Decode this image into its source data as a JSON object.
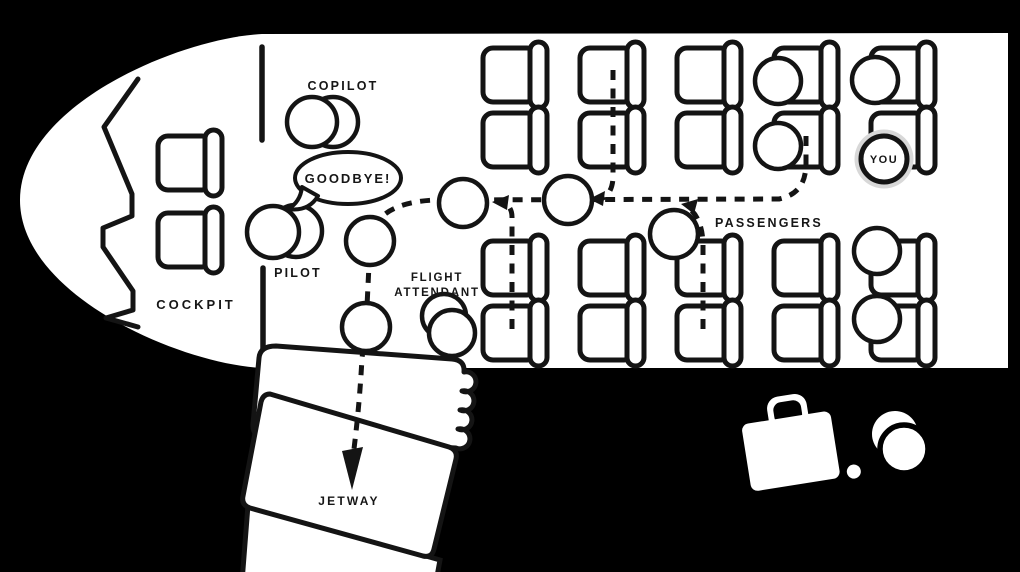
{
  "colors": {
    "background": "#000000",
    "fuselage": "#ffffff",
    "line": "#141414",
    "you_halo": "#d8d8d8"
  },
  "labels": {
    "cockpit": "COCKPIT",
    "pilot": "PILOT",
    "copilot": "COPILOT",
    "flight_attendant_line1": "FLIGHT",
    "flight_attendant_line2": "ATTENDANT",
    "passengers": "PASSENGERS",
    "you": "YOU",
    "jetway": "JETWAY",
    "speech_bubble": "GOODBYE!"
  }
}
